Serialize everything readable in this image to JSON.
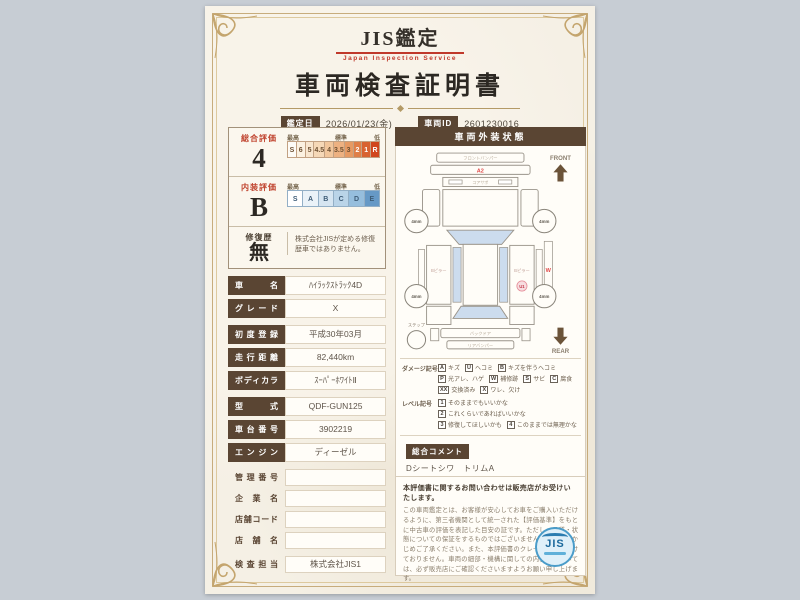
{
  "header": {
    "brand": "JIS鑑定",
    "brand_sub": "Japan Inspection Service",
    "title": "車両検査証明書",
    "date_label": "鑑定日",
    "date_value": "2026/01/23(金)",
    "id_label": "車両ID",
    "id_value": "2601230016"
  },
  "colors": {
    "accent_brown": "#5a4533",
    "accent_red": "#c0392b",
    "frame_gold": "#c7ac7c",
    "paper": "#f5f0e5",
    "scale_orange_max": "#d0461d",
    "scale_blue_max": "#6699c6"
  },
  "ratings": {
    "scale_header": {
      "high": "最高",
      "mid": "標準",
      "low": "低"
    },
    "overall": {
      "label": "総合評価",
      "value": "4",
      "scale": [
        "S",
        "6",
        "5",
        "4.5",
        "4",
        "3.5",
        "3",
        "2",
        "1",
        "R"
      ]
    },
    "interior": {
      "label": "内装評価",
      "value": "B",
      "scale": [
        "S",
        "A",
        "B",
        "C",
        "D",
        "E"
      ]
    },
    "repair": {
      "label": "修復歴",
      "value": "無",
      "note": "株式会社JISが定める修復歴車ではありません。"
    }
  },
  "details": {
    "rows": [
      {
        "label": "車名",
        "value": "ﾊｲﾗｯｸｽﾄﾗｯｸ4D"
      },
      {
        "label": "グレード",
        "value": "X"
      },
      {
        "label": "初度登録",
        "value": "平成30年03月"
      },
      {
        "label": "走行距離",
        "value": "82,440km"
      },
      {
        "label": "ボディカラー",
        "value": "ｽｰﾊﾟｰﾎﾜｲﾄⅡ"
      },
      {
        "label": "型式",
        "value": "QDF-GUN125"
      },
      {
        "label": "車台番号",
        "value": "3902219"
      },
      {
        "label": "エンジン",
        "value": "ディーゼル"
      },
      {
        "label": "管理番号",
        "value": ""
      },
      {
        "label": "企業名",
        "value": ""
      },
      {
        "label": "店舗コード",
        "value": ""
      },
      {
        "label": "店舗名",
        "value": ""
      },
      {
        "label": "検査担当",
        "value": "株式会社JIS1"
      }
    ]
  },
  "diagram": {
    "title": "車両外装状態",
    "front": "FRONT",
    "rear": "REAR",
    "front_bumper": "フロントバンパー",
    "core_support": "コアサポ",
    "mirror_left": "左ミラー",
    "mirror_right": "右ミラー",
    "pillar_left": "Bピラー",
    "pillar_right": "Bピラー",
    "rear_gate": "バックドア",
    "rear_bumper": "リアバンパー",
    "step": "ステップ",
    "tread": "4mm",
    "marks": {
      "bonnet": "A2",
      "side": "W",
      "quarter": "U1"
    }
  },
  "legend": {
    "damage_label": "ダメージ記号",
    "damage": [
      {
        "sym": "A",
        "label": "キズ"
      },
      {
        "sym": "U",
        "label": "ヘコミ"
      },
      {
        "sym": "B",
        "label": "キズを伴うヘコミ"
      },
      {
        "sym": "P",
        "label": "光アレ、ハゲ"
      },
      {
        "sym": "W",
        "label": "補修跡"
      },
      {
        "sym": "S",
        "label": "サビ"
      },
      {
        "sym": "C",
        "label": "腐食"
      },
      {
        "sym": "XX",
        "label": "交換済み"
      },
      {
        "sym": "X",
        "label": "ワレ、欠け"
      }
    ],
    "level_label": "レベル記号",
    "levels": [
      {
        "sym": "1",
        "label": "そのままでもいいかな"
      },
      {
        "sym": "2",
        "label": "これくらいであればいいかな"
      },
      {
        "sym": "3",
        "label": "修復してほしいかも"
      },
      {
        "sym": "4",
        "label": "このままでは無理かな"
      }
    ]
  },
  "comment": {
    "title": "総合コメント",
    "lines": [
      "Dシートシワ　トリムA",
      "セットバックAU　左ステップX",
      "小A、U、Pアセ"
    ]
  },
  "disclaimer": {
    "heading": "本評価書に関するお問い合わせは販売店がお受けいたします。",
    "body": "この車両鑑定とは、お客様が安心してお車をご購入いただけるように、第三者機関として統一された【評価基準】をもとに中古車の評価を表記した目安の証です。ただし、品質・状態についての保証をするものではございませんので、あらかじめご了承ください。また、本評価書のクレームは受け付けておりません。車両の細部・機構に関しての内容等については、必ず販売店にご確認くださいますようお願い申し上げます。"
  },
  "logo": {
    "text": "JIS"
  }
}
